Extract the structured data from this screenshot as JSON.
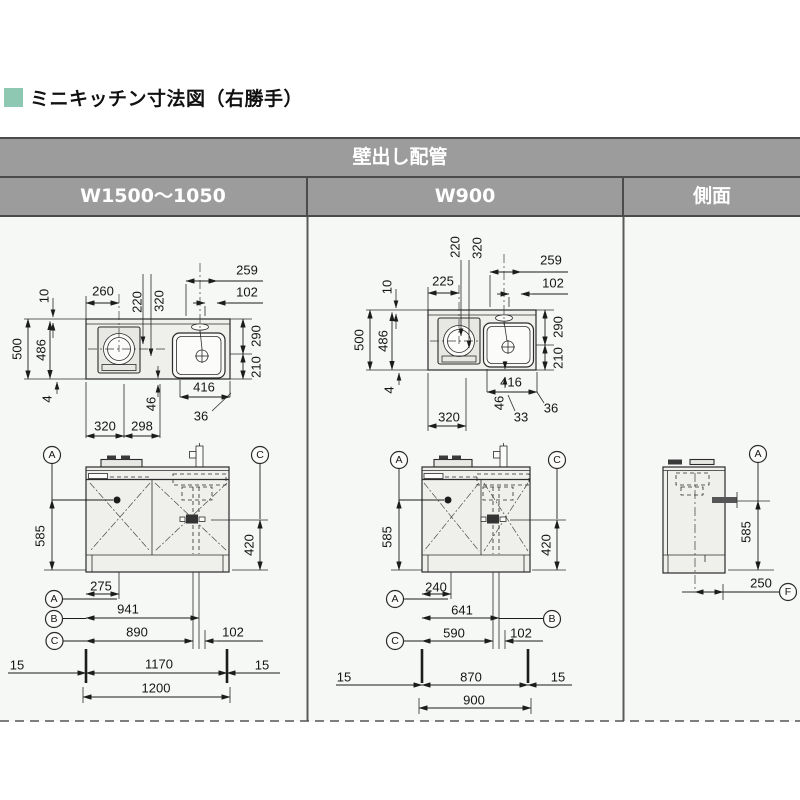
{
  "title": {
    "label": "ミニキッチン寸法図（右勝手）"
  },
  "table": {
    "main_header": "壁出し配管",
    "col1": "W1500～1050",
    "col2": "W900",
    "col3": "側面"
  },
  "colors": {
    "accent_square": "#8ec7b2",
    "header_bg": "#9c9c9c",
    "header_border": "#4b4b4b",
    "header_text": "#ffffff",
    "content_bg": "#f5f8f5",
    "line_color": "#2b2b2b"
  },
  "w1500_plan": {
    "d260": "260",
    "d220": "220",
    "d320t": "320",
    "d259": "259",
    "d102": "102",
    "d10": "10",
    "d500": "500",
    "d486": "486",
    "d4": "4",
    "d290": "290",
    "d210": "210",
    "d416": "416",
    "d36": "36",
    "d46": "46",
    "d320b": "320",
    "d298": "298"
  },
  "w1500_elev": {
    "refA_top": "A",
    "refC_top": "C",
    "d585": "585",
    "d420": "420",
    "d275": "275",
    "refA": "A",
    "d941": "941",
    "refB": "B",
    "d890": "890",
    "d102": "102",
    "refC": "C",
    "d15l": "15",
    "d1170": "1170",
    "d15r": "15",
    "d1200": "1200"
  },
  "w900_plan": {
    "d225": "225",
    "d220": "220",
    "d320t": "320",
    "d259": "259",
    "d102": "102",
    "d10": "10",
    "d500": "500",
    "d486": "486",
    "d4": "4",
    "d290": "290",
    "d210": "210",
    "d416": "416",
    "d46": "46",
    "d33": "33",
    "d36": "36",
    "d320b": "320"
  },
  "w900_elev": {
    "refA_top": "A",
    "refC_top": "C",
    "d585": "585",
    "d420": "420",
    "d240": "240",
    "refA": "A",
    "d641": "641",
    "refB": "B",
    "d590": "590",
    "d102": "102",
    "refC": "C",
    "d15l": "15",
    "d870": "870",
    "d15r": "15",
    "d900": "900"
  },
  "side_view": {
    "refA": "A",
    "d585": "585",
    "d250": "250",
    "refF": "F"
  }
}
